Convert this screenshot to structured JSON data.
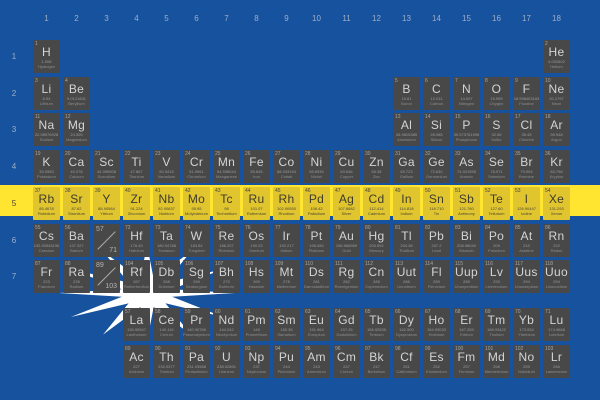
{
  "title": "Periodic table of elements overlaid on the flag of Nauru",
  "flag": {
    "field_blue": "#17529E",
    "stripe_yellow": "#FFE430",
    "star_white": "#FFFFFF",
    "highlight_cell_yellow": "#E0C52F",
    "highlight_text": "#4A4636",
    "cell_gray": "#484848"
  },
  "group_labels": [
    "1",
    "2",
    "3",
    "4",
    "5",
    "6",
    "7",
    "8",
    "9",
    "10",
    "11",
    "12",
    "13",
    "14",
    "15",
    "16",
    "17",
    "18"
  ],
  "period_labels": [
    "1",
    "2",
    "3",
    "4",
    "5",
    "6",
    "7"
  ],
  "placeholders": [
    {
      "top": "57",
      "bottom": "71",
      "period": 6,
      "group": 3
    },
    {
      "top": "89",
      "bottom": "103",
      "period": 7,
      "group": 3
    }
  ],
  "elements": [
    {
      "z": 1,
      "symbol": "H",
      "mass": "1.008",
      "name": "Hydrogen",
      "period": 1,
      "group": 1
    },
    {
      "z": 2,
      "symbol": "He",
      "mass": "4.002602",
      "name": "Helium",
      "period": 1,
      "group": 18
    },
    {
      "z": 3,
      "symbol": "Li",
      "mass": "6.94",
      "name": "Lithium",
      "period": 2,
      "group": 1
    },
    {
      "z": 4,
      "symbol": "Be",
      "mass": "9.0121831",
      "name": "Beryllium",
      "period": 2,
      "group": 2
    },
    {
      "z": 5,
      "symbol": "B",
      "mass": "10.81",
      "name": "Boron",
      "period": 2,
      "group": 13
    },
    {
      "z": 6,
      "symbol": "C",
      "mass": "12.011",
      "name": "Carbon",
      "period": 2,
      "group": 14
    },
    {
      "z": 7,
      "symbol": "N",
      "mass": "14.007",
      "name": "Nitrogen",
      "period": 2,
      "group": 15
    },
    {
      "z": 8,
      "symbol": "O",
      "mass": "15.999",
      "name": "Oxygen",
      "period": 2,
      "group": 16
    },
    {
      "z": 9,
      "symbol": "F",
      "mass": "18.998403163",
      "name": "Fluorine",
      "period": 2,
      "group": 17
    },
    {
      "z": 10,
      "symbol": "Ne",
      "mass": "20.1797",
      "name": "Neon",
      "period": 2,
      "group": 18
    },
    {
      "z": 11,
      "symbol": "Na",
      "mass": "22.98976928",
      "name": "Sodium",
      "period": 3,
      "group": 1
    },
    {
      "z": 12,
      "symbol": "Mg",
      "mass": "24.305",
      "name": "Magnesium",
      "period": 3,
      "group": 2
    },
    {
      "z": 13,
      "symbol": "Al",
      "mass": "26.9815385",
      "name": "Aluminium",
      "period": 3,
      "group": 13
    },
    {
      "z": 14,
      "symbol": "Si",
      "mass": "28.085",
      "name": "Silicon",
      "period": 3,
      "group": 14
    },
    {
      "z": 15,
      "symbol": "P",
      "mass": "30.973761998",
      "name": "Phosphorus",
      "period": 3,
      "group": 15
    },
    {
      "z": 16,
      "symbol": "S",
      "mass": "32.06",
      "name": "Sulfur",
      "period": 3,
      "group": 16
    },
    {
      "z": 17,
      "symbol": "Cl",
      "mass": "35.45",
      "name": "Chlorine",
      "period": 3,
      "group": 17
    },
    {
      "z": 18,
      "symbol": "Ar",
      "mass": "39.948",
      "name": "Argon",
      "period": 3,
      "group": 18
    },
    {
      "z": 19,
      "symbol": "K",
      "mass": "39.0983",
      "name": "Potassium",
      "period": 4,
      "group": 1
    },
    {
      "z": 20,
      "symbol": "Ca",
      "mass": "40.078",
      "name": "Calcium",
      "period": 4,
      "group": 2
    },
    {
      "z": 21,
      "symbol": "Sc",
      "mass": "44.955908",
      "name": "Scandium",
      "period": 4,
      "group": 3
    },
    {
      "z": 22,
      "symbol": "Ti",
      "mass": "47.867",
      "name": "Titanium",
      "period": 4,
      "group": 4
    },
    {
      "z": 23,
      "symbol": "V",
      "mass": "50.9415",
      "name": "Vanadium",
      "period": 4,
      "group": 5
    },
    {
      "z": 24,
      "symbol": "Cr",
      "mass": "51.9961",
      "name": "Chromium",
      "period": 4,
      "group": 6
    },
    {
      "z": 25,
      "symbol": "Mn",
      "mass": "54.938044",
      "name": "Manganese",
      "period": 4,
      "group": 7
    },
    {
      "z": 26,
      "symbol": "Fe",
      "mass": "55.845",
      "name": "Iron",
      "period": 4,
      "group": 8
    },
    {
      "z": 27,
      "symbol": "Co",
      "mass": "58.933194",
      "name": "Cobalt",
      "period": 4,
      "group": 9
    },
    {
      "z": 28,
      "symbol": "Ni",
      "mass": "58.6934",
      "name": "Nickel",
      "period": 4,
      "group": 10
    },
    {
      "z": 29,
      "symbol": "Cu",
      "mass": "63.546",
      "name": "Copper",
      "period": 4,
      "group": 11
    },
    {
      "z": 30,
      "symbol": "Zn",
      "mass": "65.38",
      "name": "Zinc",
      "period": 4,
      "group": 12
    },
    {
      "z": 31,
      "symbol": "Ga",
      "mass": "69.723",
      "name": "Gallium",
      "period": 4,
      "group": 13
    },
    {
      "z": 32,
      "symbol": "Ge",
      "mass": "72.630",
      "name": "Germanium",
      "period": 4,
      "group": 14
    },
    {
      "z": 33,
      "symbol": "As",
      "mass": "74.921595",
      "name": "Arsenic",
      "period": 4,
      "group": 15
    },
    {
      "z": 34,
      "symbol": "Se",
      "mass": "78.971",
      "name": "Selenium",
      "period": 4,
      "group": 16
    },
    {
      "z": 35,
      "symbol": "Br",
      "mass": "79.904",
      "name": "Bromine",
      "period": 4,
      "group": 17
    },
    {
      "z": 36,
      "symbol": "Kr",
      "mass": "83.798",
      "name": "Krypton",
      "period": 4,
      "group": 18
    },
    {
      "z": 37,
      "symbol": "Rb",
      "mass": "85.4678",
      "name": "Rubidium",
      "period": 5,
      "group": 1
    },
    {
      "z": 38,
      "symbol": "Sr",
      "mass": "87.62",
      "name": "Strontium",
      "period": 5,
      "group": 2
    },
    {
      "z": 39,
      "symbol": "Y",
      "mass": "88.90584",
      "name": "Yttrium",
      "period": 5,
      "group": 3
    },
    {
      "z": 40,
      "symbol": "Zr",
      "mass": "91.224",
      "name": "Zirconium",
      "period": 5,
      "group": 4
    },
    {
      "z": 41,
      "symbol": "Nb",
      "mass": "92.90637",
      "name": "Niobium",
      "period": 5,
      "group": 5
    },
    {
      "z": 42,
      "symbol": "Mo",
      "mass": "95.95",
      "name": "Molybdenum",
      "period": 5,
      "group": 6
    },
    {
      "z": 43,
      "symbol": "Tc",
      "mass": "98",
      "name": "Technetium",
      "period": 5,
      "group": 7
    },
    {
      "z": 44,
      "symbol": "Ru",
      "mass": "101.07",
      "name": "Ruthenium",
      "period": 5,
      "group": 8
    },
    {
      "z": 45,
      "symbol": "Rh",
      "mass": "102.90550",
      "name": "Rhodium",
      "period": 5,
      "group": 9
    },
    {
      "z": 46,
      "symbol": "Pd",
      "mass": "106.42",
      "name": "Palladium",
      "period": 5,
      "group": 10
    },
    {
      "z": 47,
      "symbol": "Ag",
      "mass": "107.8682",
      "name": "Silver",
      "period": 5,
      "group": 11
    },
    {
      "z": 48,
      "symbol": "Cd",
      "mass": "112.414",
      "name": "Cadmium",
      "period": 5,
      "group": 12
    },
    {
      "z": 49,
      "symbol": "In",
      "mass": "114.818",
      "name": "Indium",
      "period": 5,
      "group": 13
    },
    {
      "z": 50,
      "symbol": "Sn",
      "mass": "118.710",
      "name": "Tin",
      "period": 5,
      "group": 14
    },
    {
      "z": 51,
      "symbol": "Sb",
      "mass": "121.760",
      "name": "Antimony",
      "period": 5,
      "group": 15
    },
    {
      "z": 52,
      "symbol": "Te",
      "mass": "127.60",
      "name": "Tellurium",
      "period": 5,
      "group": 16
    },
    {
      "z": 53,
      "symbol": "I",
      "mass": "126.90447",
      "name": "Iodine",
      "period": 5,
      "group": 17
    },
    {
      "z": 54,
      "symbol": "Xe",
      "mass": "131.293",
      "name": "Xenon",
      "period": 5,
      "group": 18
    },
    {
      "z": 55,
      "symbol": "Cs",
      "mass": "132.90545196",
      "name": "Caesium",
      "period": 6,
      "group": 1
    },
    {
      "z": 56,
      "symbol": "Ba",
      "mass": "137.327",
      "name": "Barium",
      "period": 6,
      "group": 2
    },
    {
      "z": 72,
      "symbol": "Hf",
      "mass": "178.49",
      "name": "Hafnium",
      "period": 6,
      "group": 4
    },
    {
      "z": 73,
      "symbol": "Ta",
      "mass": "180.94788",
      "name": "Tantalum",
      "period": 6,
      "group": 5
    },
    {
      "z": 74,
      "symbol": "W",
      "mass": "183.84",
      "name": "Tungsten",
      "period": 6,
      "group": 6
    },
    {
      "z": 75,
      "symbol": "Re",
      "mass": "186.207",
      "name": "Rhenium",
      "period": 6,
      "group": 7
    },
    {
      "z": 76,
      "symbol": "Os",
      "mass": "190.23",
      "name": "Osmium",
      "period": 6,
      "group": 8
    },
    {
      "z": 77,
      "symbol": "Ir",
      "mass": "192.217",
      "name": "Iridium",
      "period": 6,
      "group": 9
    },
    {
      "z": 78,
      "symbol": "Pt",
      "mass": "195.084",
      "name": "Platinum",
      "period": 6,
      "group": 10
    },
    {
      "z": 79,
      "symbol": "Au",
      "mass": "196.966569",
      "name": "Gold",
      "period": 6,
      "group": 11
    },
    {
      "z": 80,
      "symbol": "Hg",
      "mass": "200.592",
      "name": "Mercury",
      "period": 6,
      "group": 12
    },
    {
      "z": 81,
      "symbol": "Tl",
      "mass": "204.38",
      "name": "Thallium",
      "period": 6,
      "group": 13
    },
    {
      "z": 82,
      "symbol": "Pb",
      "mass": "207.2",
      "name": "Lead",
      "period": 6,
      "group": 14
    },
    {
      "z": 83,
      "symbol": "Bi",
      "mass": "208.98040",
      "name": "Bismuth",
      "period": 6,
      "group": 15
    },
    {
      "z": 84,
      "symbol": "Po",
      "mass": "209",
      "name": "Polonium",
      "period": 6,
      "group": 16
    },
    {
      "z": 85,
      "symbol": "At",
      "mass": "210",
      "name": "Astatine",
      "period": 6,
      "group": 17
    },
    {
      "z": 86,
      "symbol": "Rn",
      "mass": "222",
      "name": "Radon",
      "period": 6,
      "group": 18
    },
    {
      "z": 87,
      "symbol": "Fr",
      "mass": "223",
      "name": "Francium",
      "period": 7,
      "group": 1
    },
    {
      "z": 88,
      "symbol": "Ra",
      "mass": "226",
      "name": "Radium",
      "period": 7,
      "group": 2
    },
    {
      "z": 104,
      "symbol": "Rf",
      "mass": "267",
      "name": "Rutherfordium",
      "period": 7,
      "group": 4
    },
    {
      "z": 105,
      "symbol": "Db",
      "mass": "268",
      "name": "Dubnium",
      "period": 7,
      "group": 5
    },
    {
      "z": 106,
      "symbol": "Sg",
      "mass": "269",
      "name": "Seaborgium",
      "period": 7,
      "group": 6
    },
    {
      "z": 107,
      "symbol": "Bh",
      "mass": "270",
      "name": "Bohrium",
      "period": 7,
      "group": 7
    },
    {
      "z": 108,
      "symbol": "Hs",
      "mass": "269",
      "name": "Hassium",
      "period": 7,
      "group": 8
    },
    {
      "z": 109,
      "symbol": "Mt",
      "mass": "278",
      "name": "Meitnerium",
      "period": 7,
      "group": 9
    },
    {
      "z": 110,
      "symbol": "Ds",
      "mass": "281",
      "name": "Darmstadtium",
      "period": 7,
      "group": 10
    },
    {
      "z": 111,
      "symbol": "Rg",
      "mass": "282",
      "name": "Roentgenium",
      "period": 7,
      "group": 11
    },
    {
      "z": 112,
      "symbol": "Cn",
      "mass": "285",
      "name": "Copernicium",
      "period": 7,
      "group": 12
    },
    {
      "z": 113,
      "symbol": "Uut",
      "mass": "286",
      "name": "Ununtrium",
      "period": 7,
      "group": 13
    },
    {
      "z": 114,
      "symbol": "Fl",
      "mass": "289",
      "name": "Flerovium",
      "period": 7,
      "group": 14
    },
    {
      "z": 115,
      "symbol": "Uup",
      "mass": "289",
      "name": "Ununpentium",
      "period": 7,
      "group": 15
    },
    {
      "z": 116,
      "symbol": "Lv",
      "mass": "293",
      "name": "Livermorium",
      "period": 7,
      "group": 16
    },
    {
      "z": 117,
      "symbol": "Uus",
      "mass": "294",
      "name": "Ununseptium",
      "period": 7,
      "group": 17
    },
    {
      "z": 118,
      "symbol": "Uuo",
      "mass": "294",
      "name": "Ununoctium",
      "period": 7,
      "group": 18
    },
    {
      "z": 57,
      "symbol": "La",
      "mass": "138.90547",
      "name": "Lanthanum",
      "period": "L",
      "group": 4
    },
    {
      "z": 58,
      "symbol": "Ce",
      "mass": "140.116",
      "name": "Cerium",
      "period": "L",
      "group": 5
    },
    {
      "z": 59,
      "symbol": "Pr",
      "mass": "140.90766",
      "name": "Praseodymium",
      "period": "L",
      "group": 6
    },
    {
      "z": 60,
      "symbol": "Nd",
      "mass": "144.242",
      "name": "Neodymium",
      "period": "L",
      "group": 7
    },
    {
      "z": 61,
      "symbol": "Pm",
      "mass": "145",
      "name": "Promethium",
      "period": "L",
      "group": 8
    },
    {
      "z": 62,
      "symbol": "Sm",
      "mass": "150.36",
      "name": "Samarium",
      "period": "L",
      "group": 9
    },
    {
      "z": 63,
      "symbol": "Eu",
      "mass": "151.964",
      "name": "Europium",
      "period": "L",
      "group": 10
    },
    {
      "z": 64,
      "symbol": "Gd",
      "mass": "157.25",
      "name": "Gadolinium",
      "period": "L",
      "group": 11
    },
    {
      "z": 65,
      "symbol": "Tb",
      "mass": "158.92535",
      "name": "Terbium",
      "period": "L",
      "group": 12
    },
    {
      "z": 66,
      "symbol": "Dy",
      "mass": "162.500",
      "name": "Dysprosium",
      "period": "L",
      "group": 13
    },
    {
      "z": 67,
      "symbol": "Ho",
      "mass": "164.93033",
      "name": "Holmium",
      "period": "L",
      "group": 14
    },
    {
      "z": 68,
      "symbol": "Er",
      "mass": "167.259",
      "name": "Erbium",
      "period": "L",
      "group": 15
    },
    {
      "z": 69,
      "symbol": "Tm",
      "mass": "168.93422",
      "name": "Thulium",
      "period": "L",
      "group": 16
    },
    {
      "z": 70,
      "symbol": "Yb",
      "mass": "173.054",
      "name": "Ytterbium",
      "period": "L",
      "group": 17
    },
    {
      "z": 71,
      "symbol": "Lu",
      "mass": "174.9668",
      "name": "Lutetium",
      "period": "L",
      "group": 18
    },
    {
      "z": 89,
      "symbol": "Ac",
      "mass": "227",
      "name": "Actinium",
      "period": "A",
      "group": 4
    },
    {
      "z": 90,
      "symbol": "Th",
      "mass": "232.0377",
      "name": "Thorium",
      "period": "A",
      "group": 5
    },
    {
      "z": 91,
      "symbol": "Pa",
      "mass": "231.03588",
      "name": "Protactinium",
      "period": "A",
      "group": 6
    },
    {
      "z": 92,
      "symbol": "U",
      "mass": "238.02891",
      "name": "Uranium",
      "period": "A",
      "group": 7
    },
    {
      "z": 93,
      "symbol": "Np",
      "mass": "237",
      "name": "Neptunium",
      "period": "A",
      "group": 8
    },
    {
      "z": 94,
      "symbol": "Pu",
      "mass": "244",
      "name": "Plutonium",
      "period": "A",
      "group": 9
    },
    {
      "z": 95,
      "symbol": "Am",
      "mass": "243",
      "name": "Americium",
      "period": "A",
      "group": 10
    },
    {
      "z": 96,
      "symbol": "Cm",
      "mass": "247",
      "name": "Curium",
      "period": "A",
      "group": 11
    },
    {
      "z": 97,
      "symbol": "Bk",
      "mass": "247",
      "name": "Berkelium",
      "period": "A",
      "group": 12
    },
    {
      "z": 98,
      "symbol": "Cf",
      "mass": "251",
      "name": "Californium",
      "period": "A",
      "group": 13
    },
    {
      "z": 99,
      "symbol": "Es",
      "mass": "252",
      "name": "Einsteinium",
      "period": "A",
      "group": 14
    },
    {
      "z": 100,
      "symbol": "Fm",
      "mass": "257",
      "name": "Fermium",
      "period": "A",
      "group": 15
    },
    {
      "z": 101,
      "symbol": "Md",
      "mass": "258",
      "name": "Mendelevium",
      "period": "A",
      "group": 16
    },
    {
      "z": 102,
      "symbol": "No",
      "mass": "259",
      "name": "Nobelium",
      "period": "A",
      "group": 17
    },
    {
      "z": 103,
      "symbol": "Lr",
      "mass": "266",
      "name": "Lawrencium",
      "period": "A",
      "group": 18
    }
  ]
}
